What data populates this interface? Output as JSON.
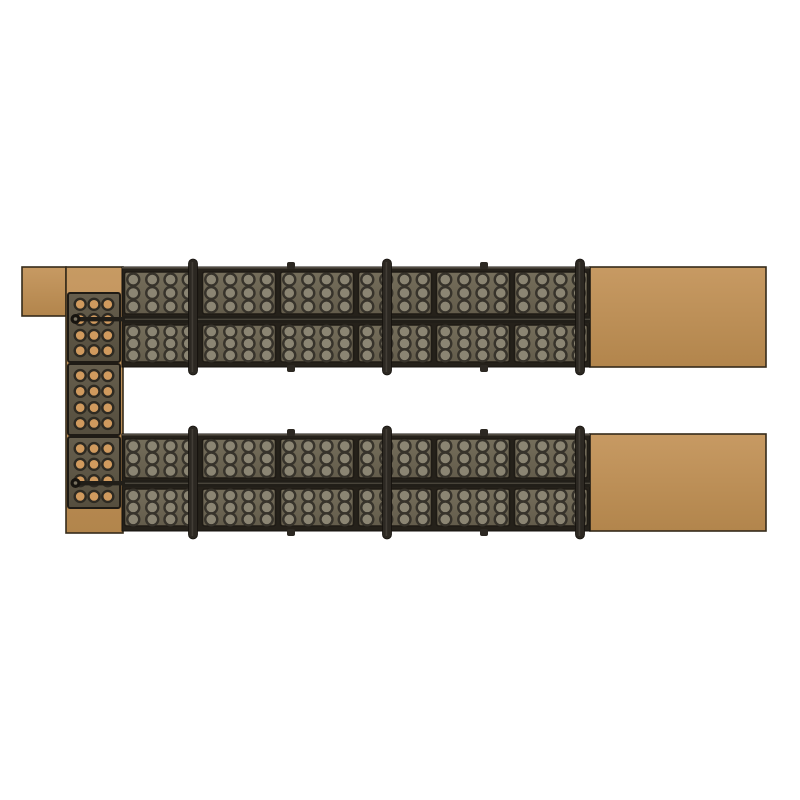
{
  "scene": {
    "description": "Top view render of a modular steel rail structure with perforated plates and timber planks",
    "canvas": {
      "width": 800,
      "height": 800,
      "background": "#ffffff"
    },
    "colors": {
      "background": "#ffffff",
      "wood_light": "#c79a63",
      "wood": "#bd8f5a",
      "wood_dark": "#b2854c",
      "wood_outline": "#352b1a",
      "frame": "#25211a",
      "frame_edge": "#14110d",
      "frame_highlight": "#7d776a",
      "plate_light": "#756e5b",
      "plate_dark": "#635c4b",
      "plate_edge": "#1f1b15",
      "hole_ring": "#37332b",
      "hole_fill": "#8b8573",
      "col_plate_light": "#665e4d",
      "col_plate_dark": "#554e3e",
      "col_hole_ring": "#2e2a22",
      "col_hole_fill": "#d09a5e",
      "bar": "#211e18",
      "bar_highlight": "#5a5449",
      "post": "#2c2822",
      "post_highlight": "#57524a",
      "pin_face": "#17140f",
      "pin_inner": "#77705f"
    },
    "wood_blocks": {
      "corner_block": {
        "x": 22,
        "y": 267,
        "w": 44,
        "h": 49
      },
      "left_beam": {
        "x": 66,
        "y": 267,
        "w": 57,
        "h": 266
      },
      "right_plank_top": {
        "x": 590,
        "y": 267,
        "w": 176,
        "h": 100
      },
      "right_plank_bottom": {
        "x": 590,
        "y": 434,
        "w": 176,
        "h": 97
      }
    },
    "left_column_plates": {
      "x": 68,
      "w": 52,
      "plates": [
        {
          "y": 293,
          "h": 69
        },
        {
          "y": 364,
          "h": 71
        },
        {
          "y": 437,
          "h": 71
        }
      ],
      "hole_cols": 3,
      "hole_rows": 4
    },
    "rails": [
      {
        "name": "top-rail",
        "x": 122,
        "y": 267,
        "w": 468,
        "h": 100,
        "mid_y": 316
      },
      {
        "name": "bottom-rail",
        "x": 122,
        "y": 434,
        "w": 468,
        "h": 97,
        "mid_y": 480
      }
    ],
    "rail_sections": 6,
    "plate_hole_grid": {
      "cols": 4,
      "rows": 3
    },
    "posts_x": [
      193,
      387,
      580
    ],
    "nubs_x": [
      291,
      484
    ],
    "pins": [
      {
        "x": 75.5,
        "y": 319
      },
      {
        "x": 75.5,
        "y": 483
      }
    ]
  }
}
